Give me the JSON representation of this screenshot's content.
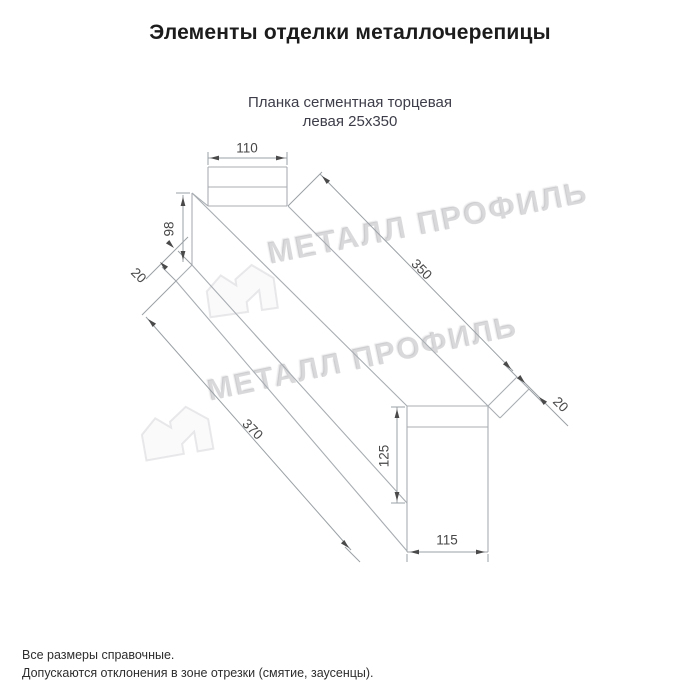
{
  "header": {
    "title": "Элементы отделки металлочерепицы"
  },
  "subtitle": {
    "line1": "Планка сегментная торцевая",
    "line2": "левая 25х350"
  },
  "footnotes": {
    "line1": "Все размеры справочные.",
    "line2": "Допускаются отклонения в зоне отрезки (смятие, заусенцы)."
  },
  "watermark": {
    "text": "МЕТАЛЛ ПРОФИЛЬ",
    "logo": "metall-profil-house-logo"
  },
  "drawing": {
    "line_color": "#a8adb2",
    "dim_line_color": "#9aa0a5",
    "arrow_color": "#4a4a4a",
    "label_color": "#474747",
    "label_font_size": 13.5,
    "structure_lines": [
      [
        208,
        167,
        287,
        167
      ],
      [
        287,
        167,
        287,
        206
      ],
      [
        287,
        206,
        208,
        206
      ],
      [
        208,
        206,
        208,
        167
      ],
      [
        208,
        187,
        287,
        187
      ],
      [
        192,
        193,
        192,
        265
      ],
      [
        192,
        193,
        208,
        206
      ],
      [
        192,
        193,
        407,
        406
      ],
      [
        288,
        206,
        488,
        406
      ],
      [
        192,
        265,
        176,
        281
      ],
      [
        192,
        265,
        407,
        503
      ],
      [
        176,
        281,
        407,
        551
      ],
      [
        407,
        406,
        488,
        406
      ],
      [
        488,
        406,
        488,
        552
      ],
      [
        488,
        552,
        407,
        552
      ],
      [
        407,
        552,
        407,
        406
      ],
      [
        407,
        427,
        488,
        427
      ],
      [
        488,
        406,
        517,
        377
      ],
      [
        517,
        377,
        529,
        389
      ],
      [
        529,
        389,
        500,
        418
      ],
      [
        500,
        418,
        488,
        406
      ]
    ],
    "dim_lines": [
      [
        208,
        165,
        208,
        152
      ],
      [
        287,
        165,
        287,
        152
      ],
      [
        208,
        158,
        287,
        158
      ],
      [
        190,
        193,
        176,
        193
      ],
      [
        183,
        195,
        183,
        262
      ],
      [
        192,
        265,
        178,
        251
      ],
      [
        176,
        281,
        162,
        267
      ],
      [
        188,
        237,
        146,
        279
      ],
      [
        288,
        206,
        322,
        172
      ],
      [
        320,
        174,
        513,
        371
      ],
      [
        517,
        377,
        505,
        365
      ],
      [
        519,
        377,
        568,
        426
      ],
      [
        529,
        389,
        544,
        404
      ],
      [
        176,
        281,
        142,
        315
      ],
      [
        146,
        317,
        351,
        550
      ],
      [
        345,
        547,
        360,
        562
      ],
      [
        405,
        407,
        391,
        407
      ],
      [
        405,
        503,
        391,
        503
      ],
      [
        397,
        407,
        397,
        503
      ],
      [
        407,
        552,
        488,
        552
      ],
      [
        407,
        554,
        407,
        562
      ],
      [
        488,
        554,
        488,
        562
      ]
    ],
    "arrows": [
      {
        "x": 210,
        "y": 158,
        "a": 180
      },
      {
        "x": 285,
        "y": 158,
        "a": 0
      },
      {
        "x": 183,
        "y": 197,
        "a": 270
      },
      {
        "x": 183,
        "y": 260,
        "a": 90
      },
      {
        "x": 174,
        "y": 248,
        "a": 45
      },
      {
        "x": 160,
        "y": 262,
        "a": 225
      },
      {
        "x": 322,
        "y": 176,
        "a": 225
      },
      {
        "x": 511,
        "y": 369,
        "a": 45
      },
      {
        "x": 525,
        "y": 383,
        "a": 45
      },
      {
        "x": 539,
        "y": 397,
        "a": 225
      },
      {
        "x": 148,
        "y": 319,
        "a": 225
      },
      {
        "x": 349,
        "y": 548,
        "a": 45
      },
      {
        "x": 397,
        "y": 409,
        "a": 270
      },
      {
        "x": 397,
        "y": 501,
        "a": 90
      },
      {
        "x": 410,
        "y": 552,
        "a": 180
      },
      {
        "x": 485,
        "y": 552,
        "a": 0
      }
    ],
    "labels": [
      {
        "text": "110",
        "x": 247,
        "y": 149,
        "r": 0
      },
      {
        "text": "98",
        "x": 170,
        "y": 229,
        "r": -90
      },
      {
        "text": "20",
        "x": 138,
        "y": 276,
        "r": 45
      },
      {
        "text": "350",
        "x": 421,
        "y": 270,
        "r": 45
      },
      {
        "text": "20",
        "x": 560,
        "y": 405,
        "r": 45
      },
      {
        "text": "370",
        "x": 252,
        "y": 430,
        "r": 45
      },
      {
        "text": "125",
        "x": 385,
        "y": 456,
        "r": -90
      },
      {
        "text": "115",
        "x": 447,
        "y": 541,
        "r": 0
      }
    ]
  }
}
